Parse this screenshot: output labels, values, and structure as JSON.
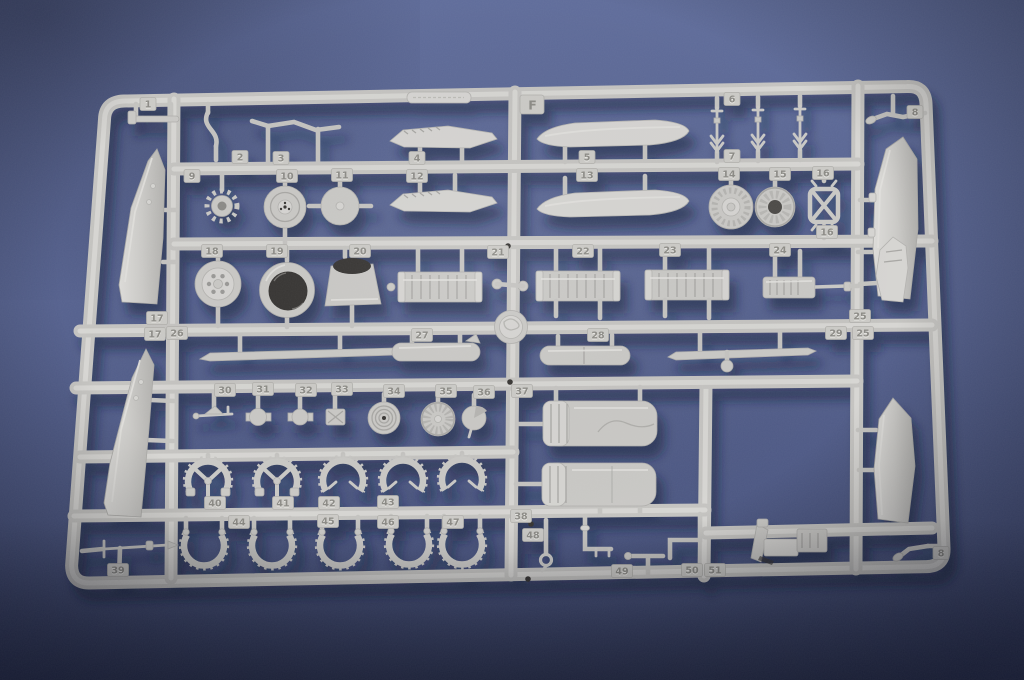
{
  "colors": {
    "background_top": "#5f6c9a",
    "background_bottom": "#3e4870",
    "plastic_base": "#c9c8c5",
    "plastic_highlight": "#d9d8d5",
    "plastic_shadow": "#aeadaa",
    "cavity_dark": "#353331",
    "tag_plate": "#cbcac6",
    "tag_text": "#8b8a85",
    "shadow": "#151b38"
  },
  "sprue": {
    "letter_tag": "F",
    "part_tags": [
      {
        "label": "1",
        "x": 148,
        "y": 104
      },
      {
        "label": "2",
        "x": 240,
        "y": 157
      },
      {
        "label": "3",
        "x": 281,
        "y": 158
      },
      {
        "label": "4",
        "x": 417,
        "y": 158
      },
      {
        "label": "5",
        "x": 587,
        "y": 157
      },
      {
        "label": "6",
        "x": 732,
        "y": 99
      },
      {
        "label": "7",
        "x": 732,
        "y": 156
      },
      {
        "label": "8",
        "x": 915,
        "y": 112
      },
      {
        "label": "8",
        "x": 941,
        "y": 553
      },
      {
        "label": "9",
        "x": 192,
        "y": 176
      },
      {
        "label": "10",
        "x": 287,
        "y": 176
      },
      {
        "label": "11",
        "x": 342,
        "y": 175
      },
      {
        "label": "12",
        "x": 417,
        "y": 176
      },
      {
        "label": "13",
        "x": 587,
        "y": 175
      },
      {
        "label": "14",
        "x": 729,
        "y": 174
      },
      {
        "label": "15",
        "x": 780,
        "y": 174
      },
      {
        "label": "16",
        "x": 823,
        "y": 173
      },
      {
        "label": "16",
        "x": 827,
        "y": 232
      },
      {
        "label": "17",
        "x": 157,
        "y": 318
      },
      {
        "label": "17",
        "x": 155,
        "y": 334
      },
      {
        "label": "18",
        "x": 212,
        "y": 251
      },
      {
        "label": "19",
        "x": 277,
        "y": 251
      },
      {
        "label": "20",
        "x": 360,
        "y": 251
      },
      {
        "label": "21",
        "x": 498,
        "y": 252
      },
      {
        "label": "22",
        "x": 583,
        "y": 251
      },
      {
        "label": "23",
        "x": 670,
        "y": 250
      },
      {
        "label": "24",
        "x": 780,
        "y": 250
      },
      {
        "label": "25",
        "x": 860,
        "y": 316
      },
      {
        "label": "25",
        "x": 863,
        "y": 333
      },
      {
        "label": "26",
        "x": 177,
        "y": 333
      },
      {
        "label": "27",
        "x": 422,
        "y": 335
      },
      {
        "label": "28",
        "x": 598,
        "y": 335
      },
      {
        "label": "29",
        "x": 836,
        "y": 333
      },
      {
        "label": "30",
        "x": 225,
        "y": 390
      },
      {
        "label": "31",
        "x": 263,
        "y": 389
      },
      {
        "label": "32",
        "x": 306,
        "y": 390
      },
      {
        "label": "33",
        "x": 342,
        "y": 389
      },
      {
        "label": "34",
        "x": 394,
        "y": 391
      },
      {
        "label": "35",
        "x": 446,
        "y": 391
      },
      {
        "label": "36",
        "x": 484,
        "y": 392
      },
      {
        "label": "37",
        "x": 522,
        "y": 391
      },
      {
        "label": "38",
        "x": 521,
        "y": 516
      },
      {
        "label": "39",
        "x": 118,
        "y": 570
      },
      {
        "label": "40",
        "x": 215,
        "y": 503
      },
      {
        "label": "41",
        "x": 283,
        "y": 503
      },
      {
        "label": "42",
        "x": 329,
        "y": 503
      },
      {
        "label": "43",
        "x": 388,
        "y": 502
      },
      {
        "label": "44",
        "x": 239,
        "y": 522
      },
      {
        "label": "45",
        "x": 328,
        "y": 521
      },
      {
        "label": "46",
        "x": 388,
        "y": 522
      },
      {
        "label": "47",
        "x": 453,
        "y": 522
      },
      {
        "label": "48",
        "x": 533,
        "y": 535
      },
      {
        "label": "49",
        "x": 622,
        "y": 571
      },
      {
        "label": "50",
        "x": 692,
        "y": 570
      },
      {
        "label": "51",
        "x": 715,
        "y": 570
      }
    ]
  }
}
